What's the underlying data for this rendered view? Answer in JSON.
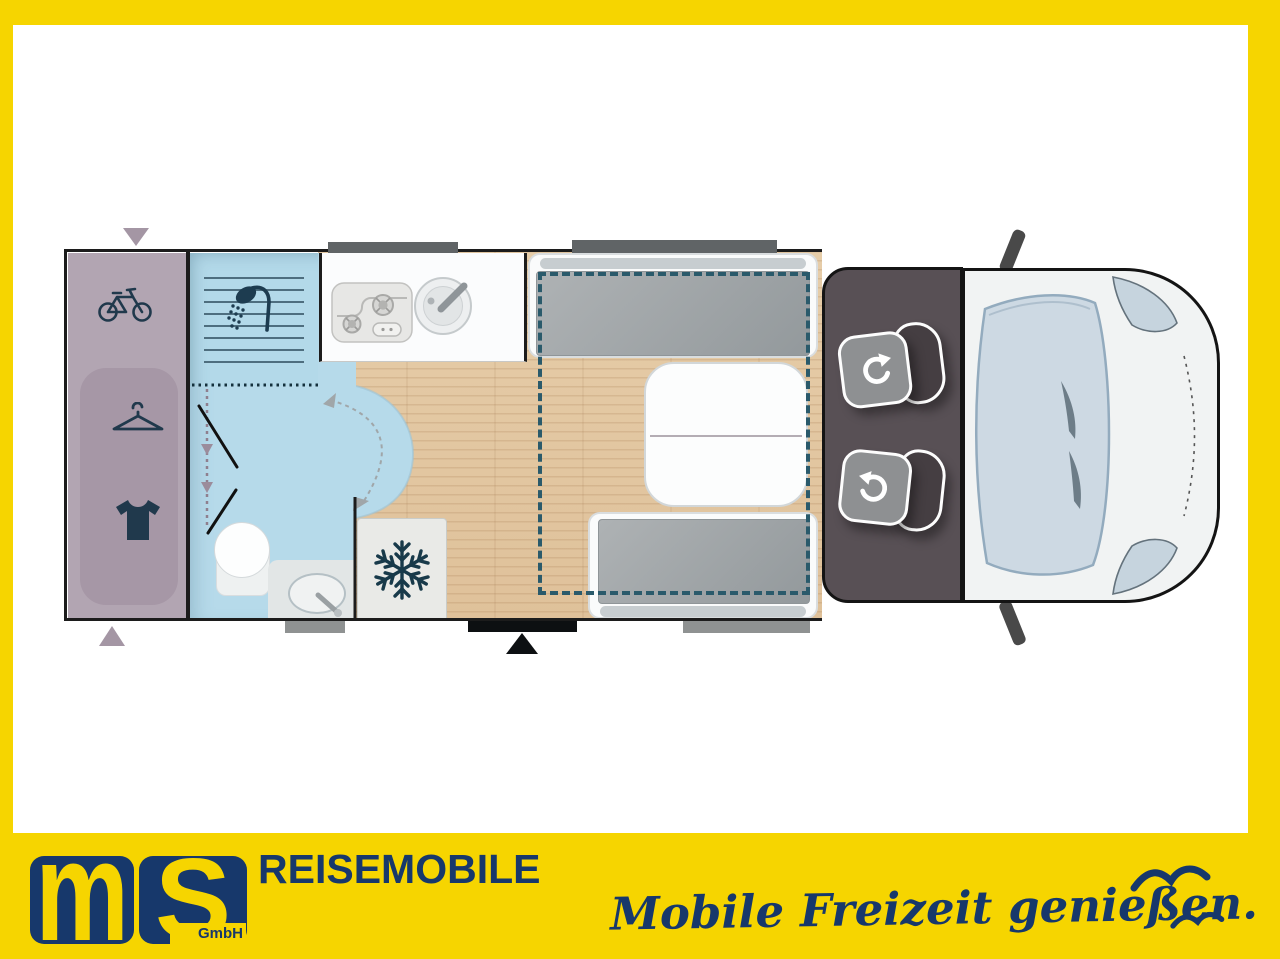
{
  "brand": {
    "logo_text_1": "m",
    "logo_text_2": "S",
    "logo_subtext": "GmbH",
    "wordmark": "REISEMOBILE",
    "slogan": "Mobile Freizeit genießen."
  },
  "floorplan": {
    "type": "motorhome-top-view",
    "areas": [
      "rear-garage",
      "wardrobe",
      "shower",
      "bathroom",
      "kitchen",
      "fridge",
      "lounge-seating",
      "table",
      "drop-down-bed-outline",
      "cab-swivel-seats",
      "vehicle-front"
    ],
    "icons": [
      "bicycle-icon",
      "hanger-icon",
      "shirt-icon",
      "shower-icon",
      "stove-icon",
      "sink-icon",
      "snowflake-icon",
      "swivel-seat-icon",
      "entry-arrow-icon",
      "seagull-icon"
    ]
  },
  "colors": {
    "frame_yellow": "#f6d500",
    "brand_navy": "#17386b",
    "garage_purple": "#b2a5b2",
    "bathroom_blue": "#b6daea",
    "wood_floor": "#e2c7a3",
    "cab_floor": "#585055",
    "bed_dash_teal": "#2a5a6b",
    "mattress_gray": "#9aa0a3",
    "icon_navy": "#1d3c50"
  }
}
